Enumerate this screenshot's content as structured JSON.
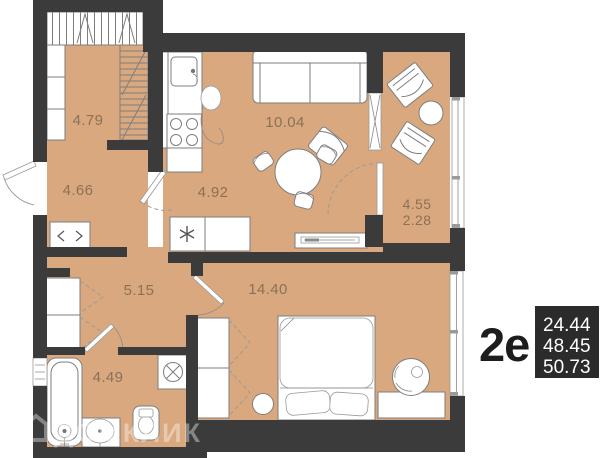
{
  "plan": {
    "type_label": "2e",
    "area_values": [
      "24.44",
      "48.45",
      "50.73"
    ],
    "rooms": {
      "wardrobe": "4.79",
      "hall": "4.66",
      "kitchen_living": "10.04",
      "kitchen_zone": "4.92",
      "corridor": "5.15",
      "bathroom": "4.49",
      "bedroom": "14.40",
      "balcony_full": "4.55",
      "balcony_reduced": "2.28"
    },
    "watermark": "ДОМКЛИК",
    "colors": {
      "wall": "#3B3B3C",
      "floor": "#D9A87E",
      "label": "#8B7158",
      "stat_box": "#2B2B2B"
    }
  }
}
